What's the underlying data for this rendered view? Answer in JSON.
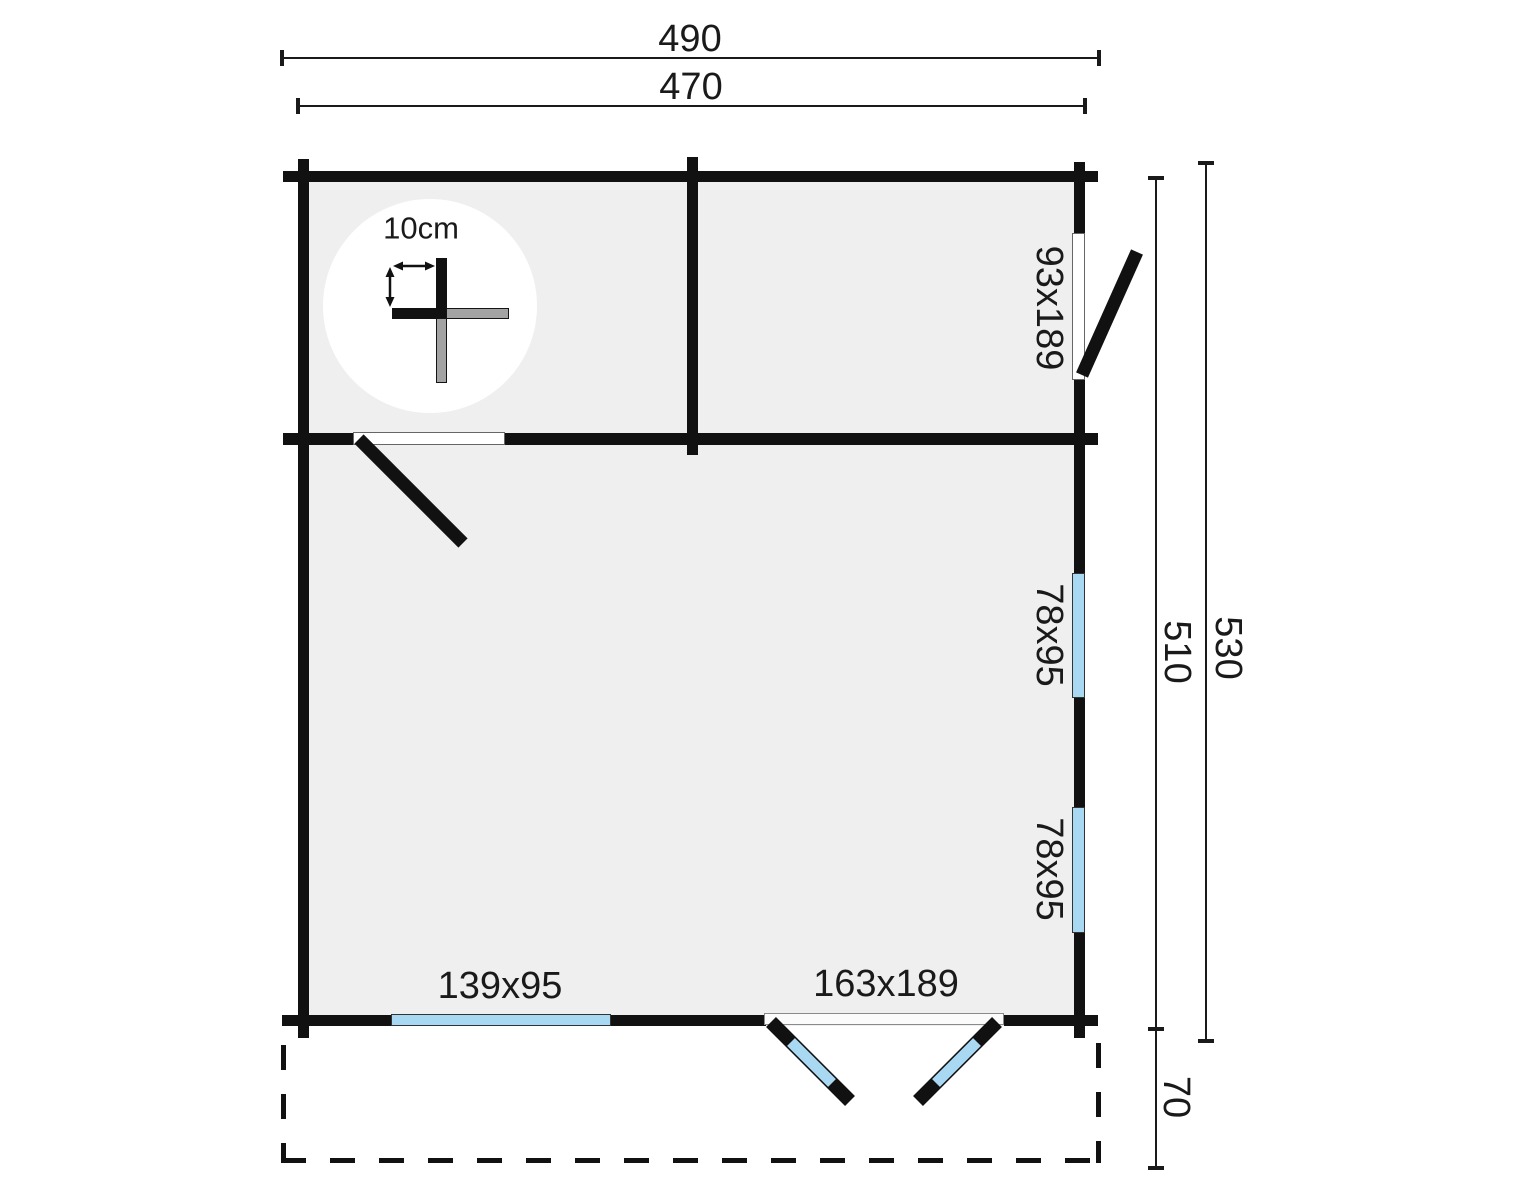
{
  "plan": {
    "dim_top_outer": "490",
    "dim_top_inner": "470",
    "dim_right_inner": "510",
    "dim_right_outer": "530",
    "dim_terrace_depth": "70",
    "right_door_size": "93x189",
    "right_window_top_size": "78x95",
    "right_window_bottom_size": "78x95",
    "bottom_window_size": "139x95",
    "bottom_door_size": "163x189",
    "wall_thickness_label": "10cm"
  },
  "colors": {
    "wall": "#111111",
    "floor": "#efefef",
    "window_blue": "#a9d9f2",
    "log_gray": "#a3a3a3",
    "text": "#1a1a1a",
    "background": "#ffffff"
  }
}
